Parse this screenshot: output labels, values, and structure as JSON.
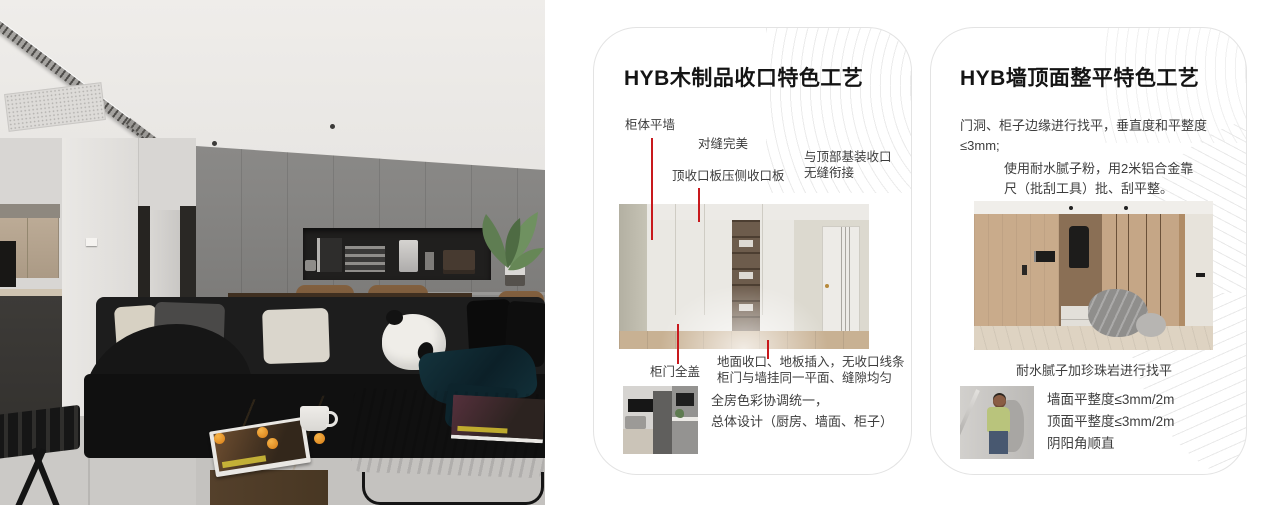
{
  "colors": {
    "page_bg": "#ffffff",
    "card_bg": "#ffffff",
    "card_border": "#e3e3e3",
    "title_color": "#141414",
    "text_color": "#3d3d3d",
    "accent_red": "#c8191d",
    "pattern_line": "#e9e9e9"
  },
  "cards": [
    {
      "title": "HYB木制品收口特色工艺",
      "annotations": {
        "wall_flush": "柜体平墙",
        "seam": "对缝完美",
        "top_board": "顶收口板压侧收口板",
        "ceiling1": "与顶部基装收口",
        "ceiling2": "无缝衔接",
        "door_cover": "柜门全盖",
        "floor1": "地面收口、地板插入，无收口线条",
        "floor2": "柜门与墙挂同一平面、缝隙均匀"
      },
      "summary1": "全房色彩协调统一，",
      "summary2": "总体设计（厨房、墙面、柜子）"
    },
    {
      "title": "HYB墙顶面整平特色工艺",
      "para1": "门洞、柜子边缘进行找平，垂直度和平整度≤3mm;",
      "para2": "使用耐水腻子粉，用2米铝合金靠尺（批刮工具）批、刮平整。",
      "caption": "耐水腻子加珍珠岩进行找平",
      "specs": [
        "墙面平整度≤3mm/2m",
        "顶面平整度≤3mm/2m",
        "阴阳角顺直"
      ]
    }
  ]
}
